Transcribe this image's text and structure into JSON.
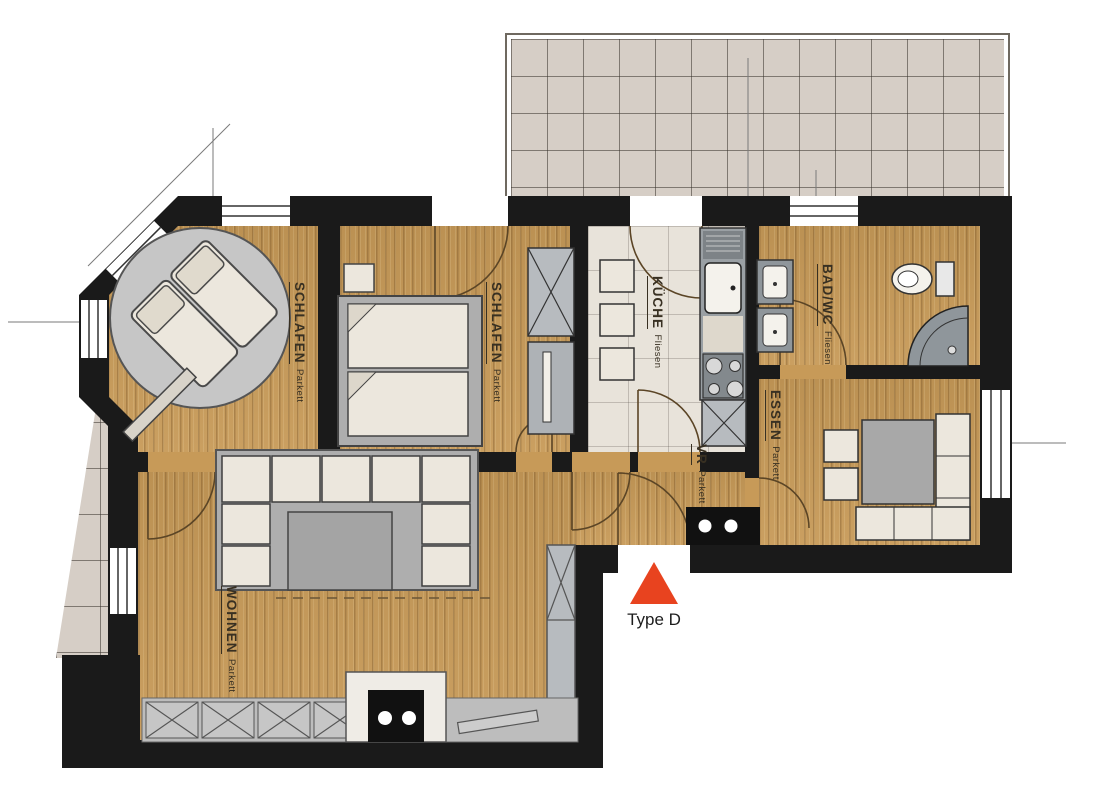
{
  "plan": {
    "marker": {
      "label": "Type D",
      "color": "#e8431f"
    },
    "rooms": [
      {
        "id": "schlafen-1",
        "name": "SCHLAFEN",
        "floor": "Parkett"
      },
      {
        "id": "schlafen-2",
        "name": "SCHLAFEN",
        "floor": "Parkett"
      },
      {
        "id": "kueche",
        "name": "KÜCHE",
        "floor": "Fliesen"
      },
      {
        "id": "bad-wc",
        "name": "BAD/WC",
        "floor": "Fliesen"
      },
      {
        "id": "essen",
        "name": "ESSEN",
        "floor": "Parkett"
      },
      {
        "id": "vr",
        "name": "VR",
        "floor": "Parkett"
      },
      {
        "id": "wohnen",
        "name": "WOHNEN",
        "floor": "Parkett"
      }
    ],
    "colors": {
      "wall": "#1a1a1a",
      "wood_floor": "#c79a58",
      "outdoor_tile": "#d6cec6",
      "kitchen_tile": "#e8e3da",
      "furniture": "#ece7dd",
      "gray_furniture": "#aeaeae",
      "marker": "#e8431f"
    }
  }
}
